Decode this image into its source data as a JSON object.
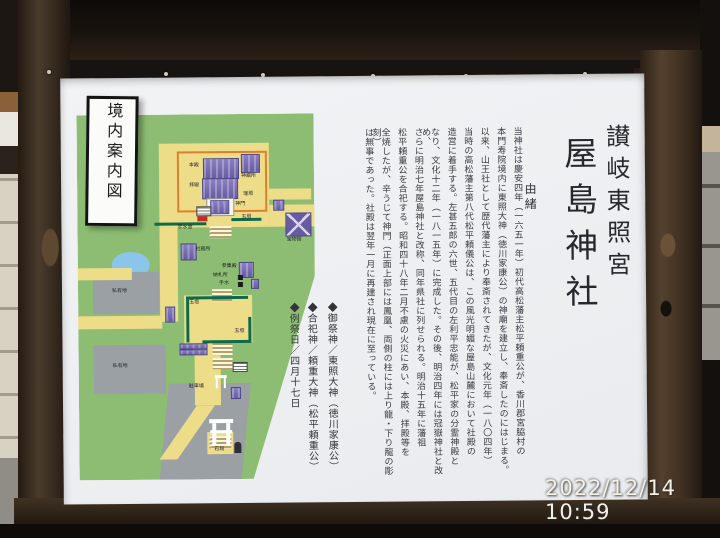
{
  "photo": {
    "timestamp": "2022/12/14 10:59"
  },
  "sign": {
    "titles": {
      "shrine_title": "讃岐東照宮",
      "shrine_name": "屋島神社",
      "section": "由緒"
    },
    "history": [
      "当神社は慶安四年（一六五一年）初代高松藩主松平頼重公が、香川郡宮脇村の",
      "本門寿院境内に東照大神（徳川家康公）の神廟を建立し、奉斎したのにはじまる。",
      "以来、山王社として歴代藩主により奉斎されてきたが、文化元年（一八〇四年）",
      "当時の高松藩主第八代松平頼儀公は、この風光明媚な屋島山麓において社殿の",
      "造営に着手する。左甚五郎の六世、五代目の左利平忠能が、松平家の分霊神殿と",
      "なり、文化十二年（一八一五年）に完成した。その後、明治四年には冠嶽神社と改め、",
      "さらに明治七年屋島神社と改称、同年県社に列せられる。明治十五年に藩祖",
      "松平頼重公を合祀する。昭和四十八年二月不慮の火災にあい、本殿、拝殿等を",
      "全焼したが、辛うじて神門（正面上部には鳳凰、両側の柱には上り龍・下り龍の彫刻）",
      "は無事であった。社殿は翌年一月に再建され現在に至っている。"
    ],
    "info": [
      "◆御祭神／東照大神（徳川家康公）",
      "◆合祀神／頼重大神（松平頼重公）",
      "◆例祭日／四月十七日"
    ],
    "map": {
      "title": "境内案内図",
      "labels": {
        "honden": "本殿",
        "haiden": "拝殿",
        "shinsensho": "神饌所",
        "mizugaki": "瑞垣",
        "shinmon": "神門",
        "tamagaki_gate": "玉垣",
        "chozuya": "手水舎",
        "shamusho": "社務所",
        "sanshuden": "参集殿",
        "nosatsusho": "納札所",
        "chozu": "手水",
        "homotsukan": "宝物館",
        "tamagaki_plaza": "玉垣",
        "tamagaki_plaza2": "玉垣",
        "private_lot_upper": "私有地",
        "private_lot_lower": "私有地",
        "parking": "駐車場",
        "ishidan": "石段"
      }
    }
  },
  "colors": {
    "map_green": "#8cbd72",
    "map_yellow": "#eedd88",
    "map_orange": "#dd7f2e",
    "building_purple": "#675ca3",
    "pond_blue": "#8cc5ea",
    "fence_green": "#0c6b4a",
    "marker_red": "#cc2a1e",
    "lot_gray": "#9aa0a4",
    "wood_brown": "#3a2d20"
  }
}
